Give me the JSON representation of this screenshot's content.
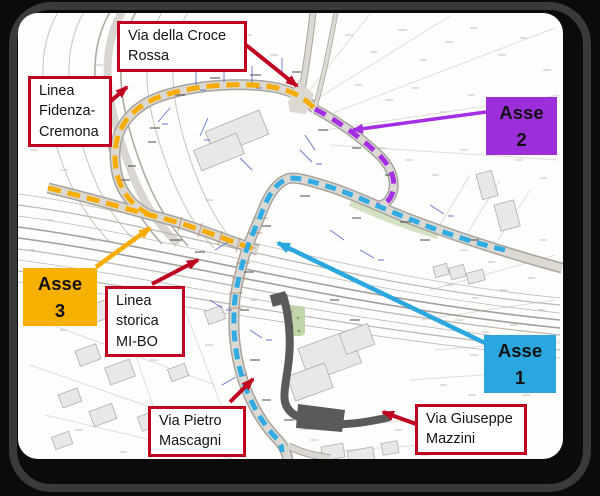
{
  "figure": {
    "kind": "road project plan with annotated axes",
    "frame_background": "#0b0b0b",
    "map_background": "#fdfdfc"
  },
  "legend_axes": [
    {
      "label": "Asse 1",
      "box_color": "#2AA7DF",
      "route_color": "#31ABE3",
      "route_style": "dashed"
    },
    {
      "label": "Asse 2",
      "box_color": "#9C2FD9",
      "route_color": "#A42EE4",
      "route_style": "dashed"
    },
    {
      "label": "Asse 3",
      "box_color": "#F6B000",
      "route_color": "#F7AC00",
      "route_style": "dashed"
    }
  ],
  "callouts": [
    {
      "id": "via-della-croce-rossa",
      "lines": [
        "Via della Croce",
        "Rossa"
      ]
    },
    {
      "id": "linea-fidenza-cremona",
      "lines": [
        "Linea",
        "Fidenza-",
        "Cremona"
      ]
    },
    {
      "id": "linea-storica-mi-bo",
      "lines": [
        "Linea",
        "storica",
        "MI-BO"
      ]
    },
    {
      "id": "via-pietro-mascagni",
      "lines": [
        "Via Pietro",
        "Mascagni"
      ]
    },
    {
      "id": "via-giuseppe-mazzini",
      "lines": [
        "Via Giuseppe",
        "Mazzini"
      ]
    }
  ],
  "colors": {
    "callout_border": "#C00021",
    "callout_arrow": "#C00021",
    "road_fill": "#DCD9D3",
    "road_casing": "#A7A39D",
    "railway_line": "#BDBAB5",
    "building_fill": "#E9E8E6",
    "dark_structure": "#5A5A5A",
    "annotation_blue": "#4A5EC5"
  }
}
